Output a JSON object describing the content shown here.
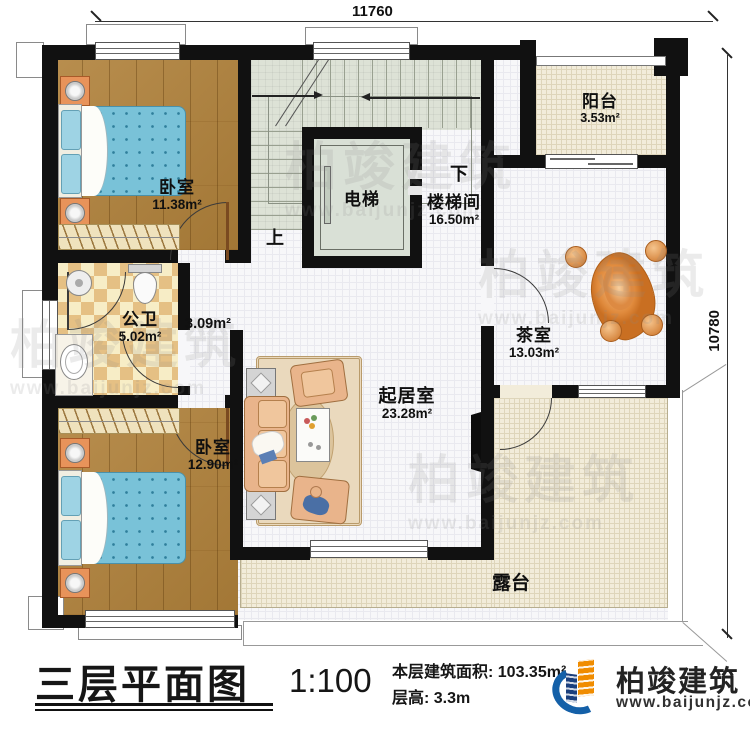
{
  "dimensions": {
    "top": "11760",
    "right": "10780"
  },
  "rooms": {
    "bedroom_top": {
      "name": "卧室",
      "area": "11.38m²"
    },
    "bathroom": {
      "name": "公卫",
      "area": "5.02m²"
    },
    "hallway": {
      "area": "3.09m²"
    },
    "bedroom_bottom": {
      "name": "卧室",
      "area": "12.90m²"
    },
    "living_room": {
      "name": "起居室",
      "area": "23.28m²"
    },
    "elevator": {
      "name": "电梯"
    },
    "stairwell": {
      "name": "楼梯间",
      "area": "16.50m²"
    },
    "balcony": {
      "name": "阳台",
      "area": "3.53m²"
    },
    "tea_room": {
      "name": "茶室",
      "area": "13.03m²"
    },
    "terrace": {
      "name": "露台"
    }
  },
  "stairs": {
    "up_label": "上",
    "down_label": "下"
  },
  "title_block": {
    "title": "三层平面图",
    "scale": "1:100",
    "area_line": "本层建筑面积: 103.35m²",
    "height_line": "层高: 3.3m"
  },
  "logo": {
    "brand": "柏竣建筑",
    "website": "www.baijunjz.com"
  },
  "watermark": {
    "brand": "柏竣建筑",
    "website": "www.baijunjz.com"
  },
  "colors": {
    "wall": "#111111",
    "wood": "#b0813a",
    "bed": "#79c2d8",
    "checker": "#e5c084",
    "stair": "#dde2d6",
    "terrace": "#f2ecda",
    "logo_blue": "#1460a8",
    "logo_orange": "#f08c00"
  }
}
